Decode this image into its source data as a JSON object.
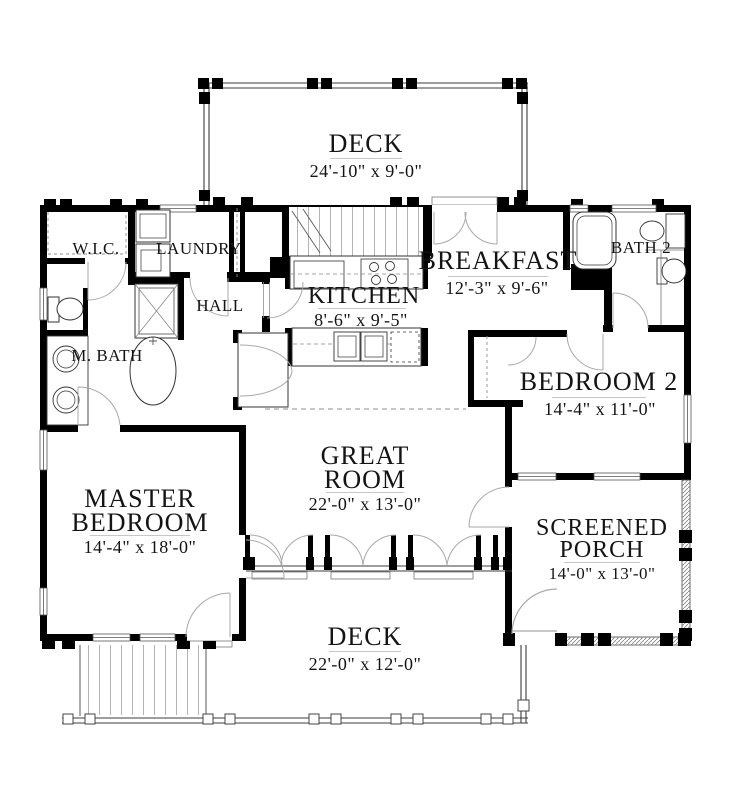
{
  "rooms": {
    "deck_top": {
      "name": "DECK",
      "dims": "24'-10\" x 9'-0\""
    },
    "wic": {
      "name": "W.I.C."
    },
    "laundry": {
      "name": "LAUNDRY"
    },
    "hall": {
      "name": "HALL"
    },
    "breakfast": {
      "name": "BREAKFAST",
      "dims": "12'-3\" x 9'-6\""
    },
    "bath2": {
      "name": "BATH 2"
    },
    "kitchen": {
      "name": "KITCHEN",
      "dims": "8'-6\" x 9'-5\""
    },
    "mbath": {
      "name": "M. BATH"
    },
    "bedroom2": {
      "name": "BEDROOM 2",
      "dims": "14'-4\" x 11'-0\""
    },
    "great_room": {
      "name_line1": "GREAT",
      "name_line2": "ROOM",
      "dims": "22'-0\" x 13'-0\""
    },
    "master": {
      "name_line1": "MASTER",
      "name_line2": "BEDROOM",
      "dims": "14'-4\" x 18'-0\""
    },
    "porch": {
      "name_line1": "SCREENED",
      "name_line2": "PORCH",
      "dims": "14'-0\" x 13'-0\""
    },
    "deck_bottom": {
      "name": "DECK",
      "dims": "22'-0\" x 12'-0\""
    }
  },
  "colors": {
    "wall": "#000000",
    "thin_line": "#3c3c3c",
    "door_arc": "#a8a8a8",
    "text": "#141414",
    "background": "#ffffff"
  }
}
